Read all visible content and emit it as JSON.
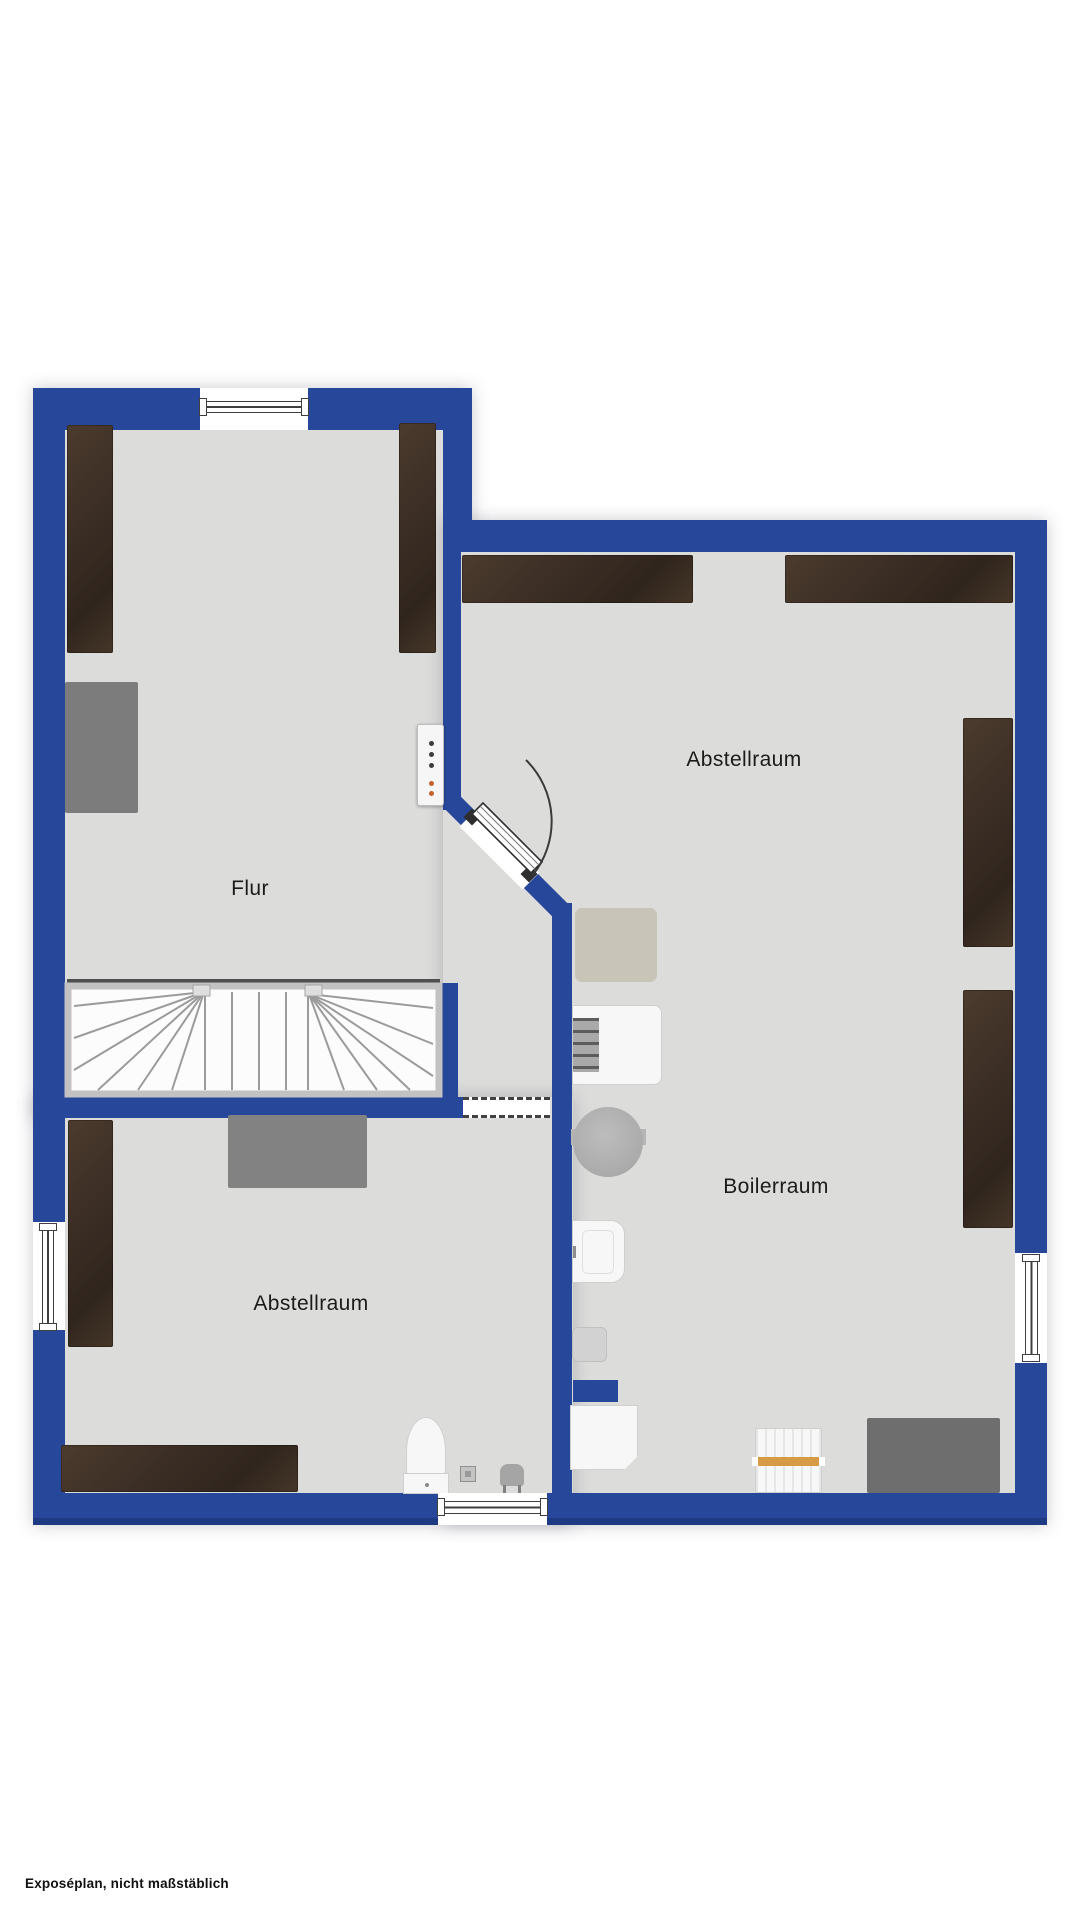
{
  "page": {
    "footnote": "Exposéplan, nicht maßstäblich"
  },
  "rooms": [
    {
      "name": "flur",
      "label": "Flur"
    },
    {
      "name": "abstellraum_top",
      "label": "Abstellraum"
    },
    {
      "name": "boilerraum",
      "label": "Boilerraum"
    },
    {
      "name": "abstellraum_bottom",
      "label": "Abstellraum"
    }
  ],
  "objects": [
    "stairs-winder",
    "door-swing-45deg",
    "passage-opening",
    "window-top",
    "window-left",
    "window-bottom",
    "window-right",
    "wood-shelf-x8",
    "desk-gray-flur",
    "desk-gray-abstellraum",
    "electrical-panel",
    "rug",
    "washing-machine",
    "round-tank",
    "water-heater",
    "small-box",
    "white-cabinet",
    "radiator",
    "toilet",
    "floor-drain",
    "stool-sink",
    "gray-unit-boilerraum"
  ],
  "colors": {
    "wall": "#27479B",
    "wall_shadow": "#1D3A82",
    "floor": "#DCDCDB",
    "wood": "#3A2D24",
    "rug": "#C8C4B7",
    "radiator_bar": "#D79B45",
    "dot_dark": "#3C3C3C",
    "dot_orange": "#C4622E",
    "ink": "#1B1B1B"
  }
}
